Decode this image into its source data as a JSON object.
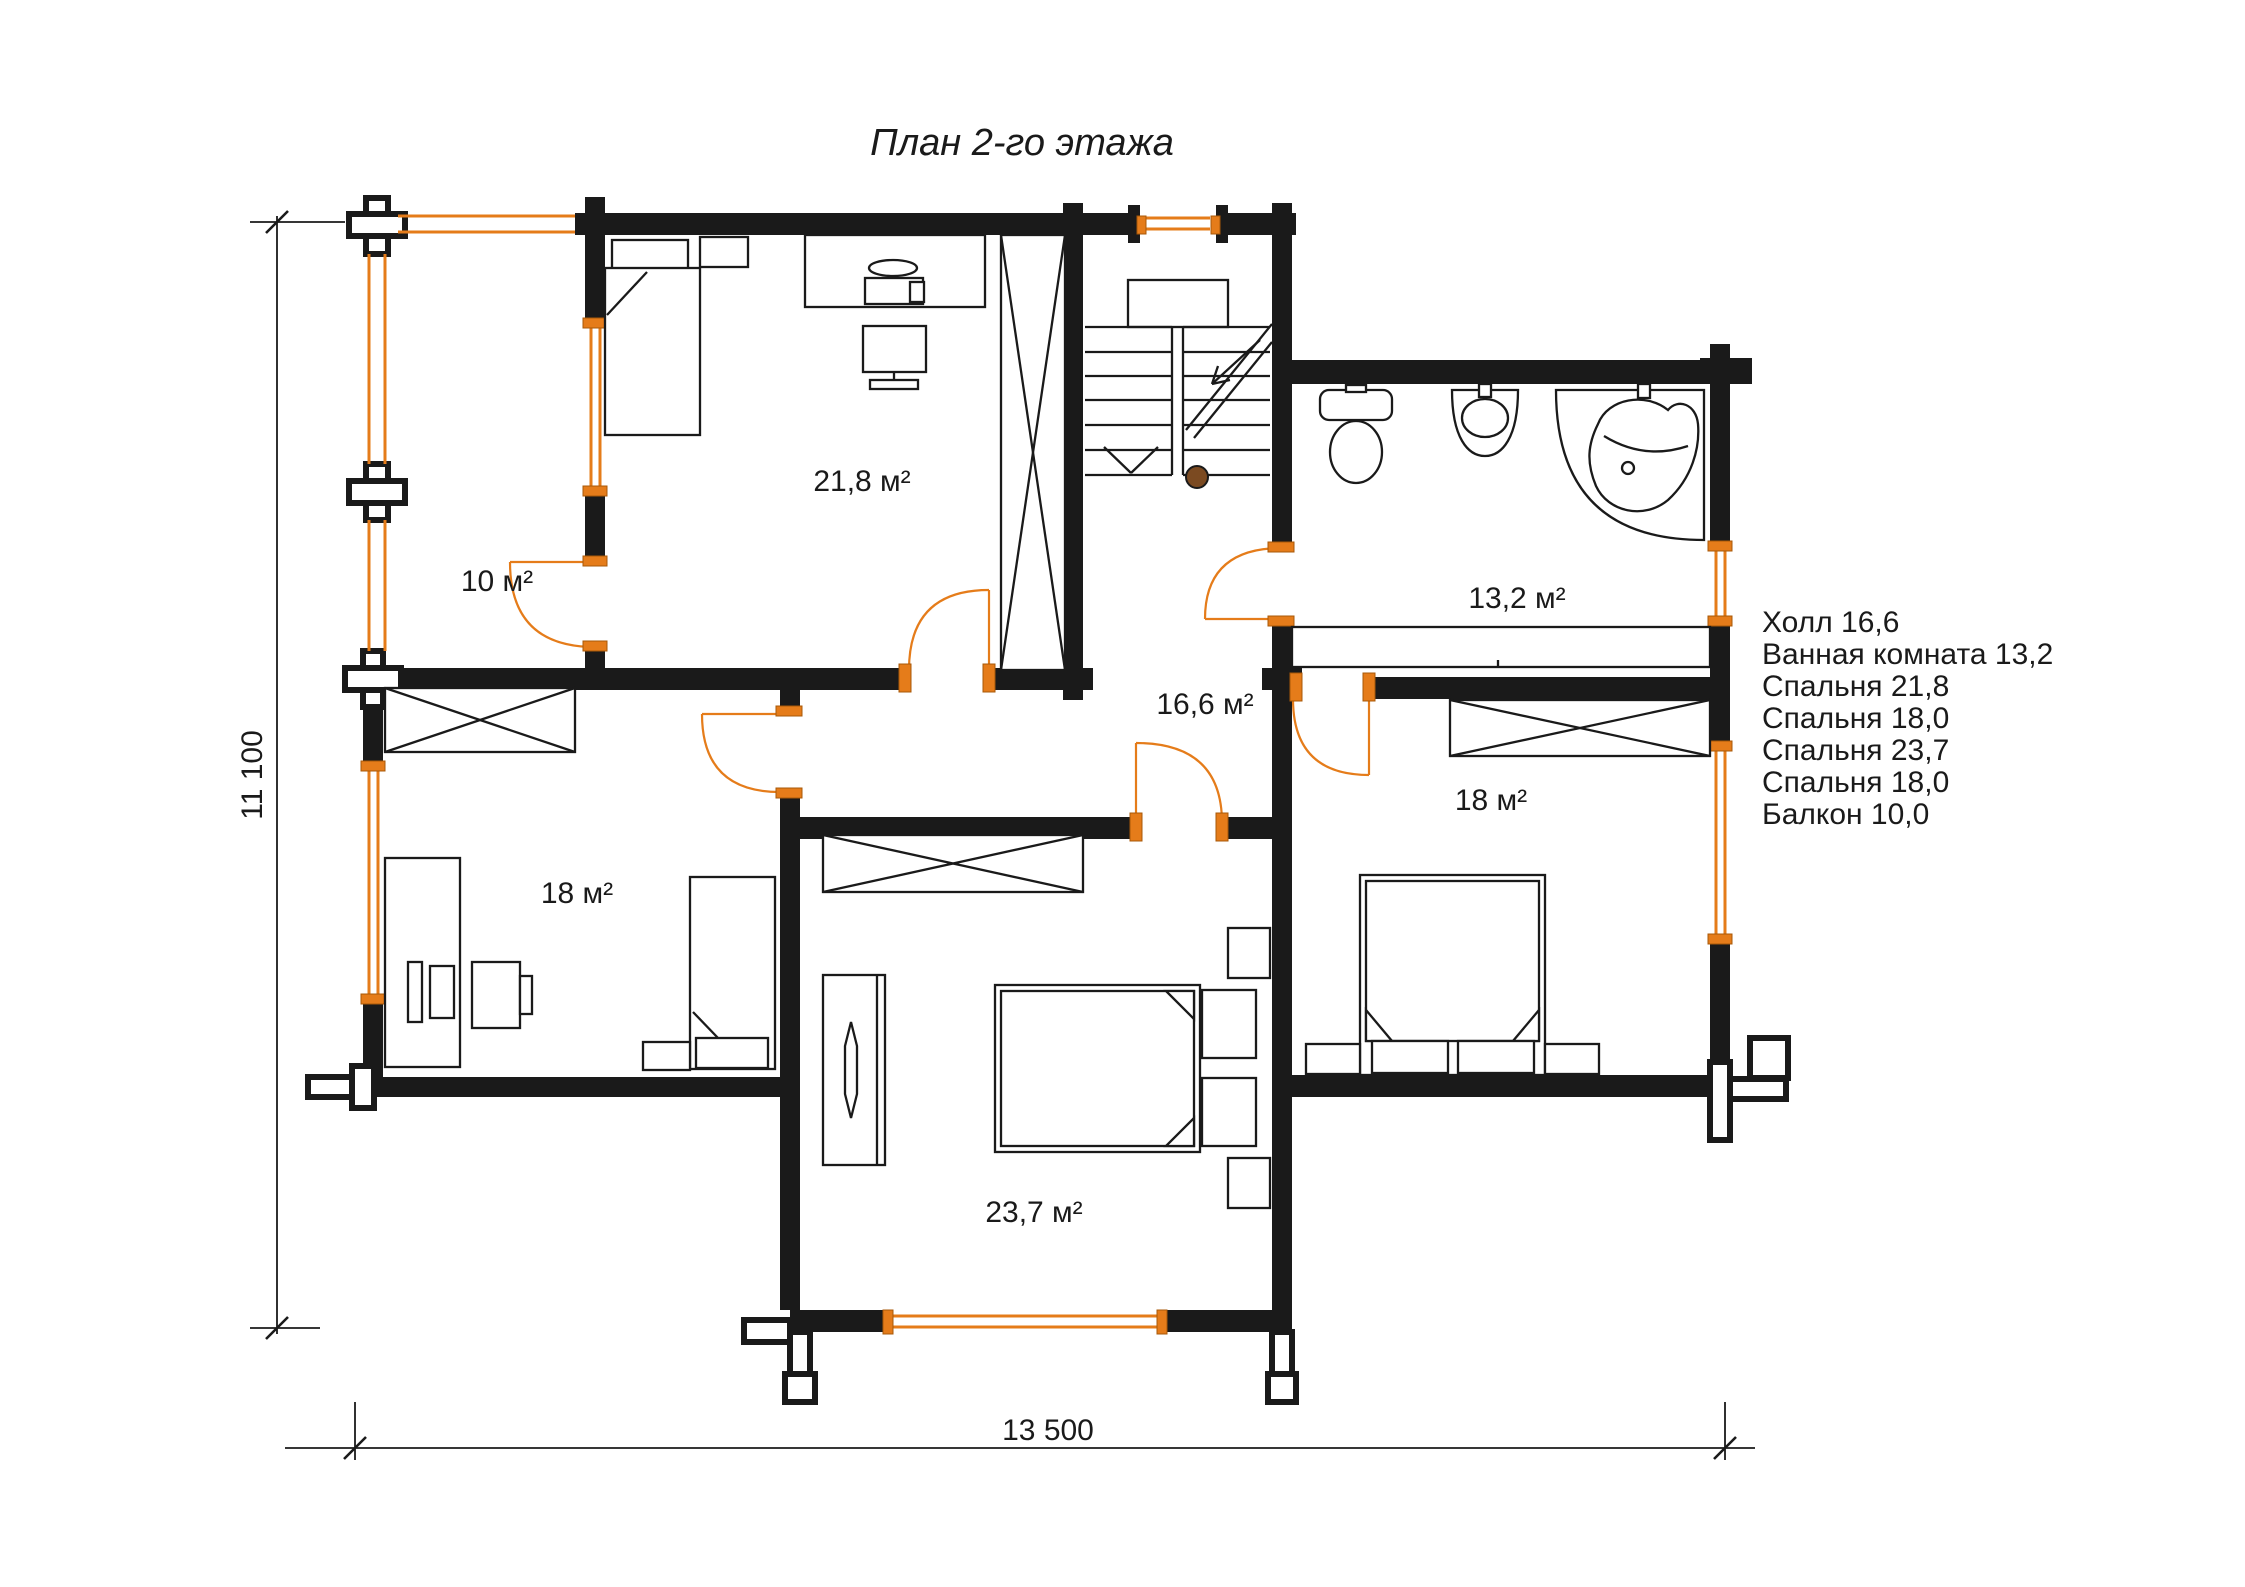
{
  "title": "План 2-го этажа",
  "colors": {
    "wall_color": "#1a1a1a",
    "accent_orange": "#e57c1a",
    "newel_brown": "#7b4a21",
    "text_color": "#1a1a1a",
    "background": "#ffffff"
  },
  "rooms": [
    {
      "name": "bedroom-top-left",
      "area_label": "21,8 м²"
    },
    {
      "name": "balcony",
      "area_label": "10 м²"
    },
    {
      "name": "bathroom",
      "area_label": "13,2 м²"
    },
    {
      "name": "hall",
      "area_label": "16,6 м²"
    },
    {
      "name": "bedroom-left",
      "area_label": "18 м²"
    },
    {
      "name": "bedroom-right",
      "area_label": "18 м²"
    },
    {
      "name": "bedroom-bottom",
      "area_label": "23,7 м²"
    }
  ],
  "legend": {
    "items": [
      "Холл 16,6",
      "Ванная комната 13,2",
      "Спальня 21,8",
      "Спальня 18,0",
      "Спальня 23,7",
      "Спальня 18,0",
      "Балкон 10,0"
    ]
  },
  "dimensions": {
    "height_label": "11 100",
    "width_label": "13 500"
  }
}
